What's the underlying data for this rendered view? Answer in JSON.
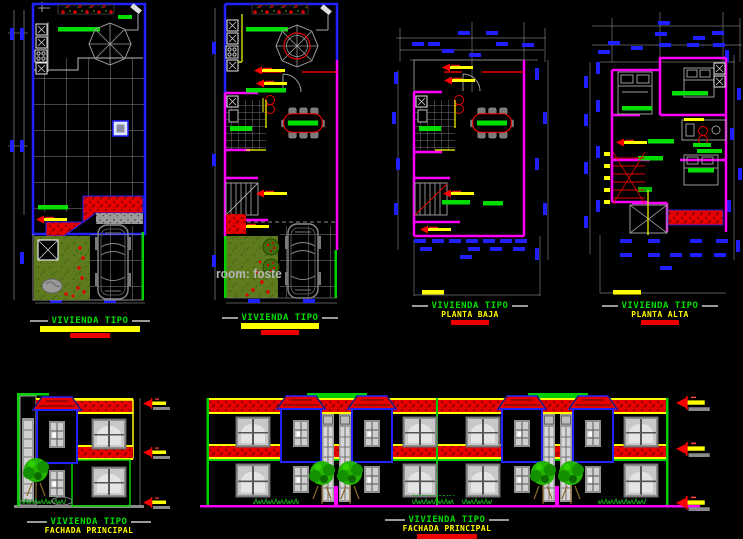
{
  "canvas": {
    "background": "#000000",
    "width": 743,
    "height": 539
  },
  "palette": {
    "wall_magenta": "#ff00ff",
    "outline_blue": "#2222ff",
    "accent_green": "#00dd00",
    "accent_yellow": "#ffff00",
    "accent_red": "#ee0000",
    "line_gray": "#9a9a9a",
    "lawn_olive": "#5d7a1c"
  },
  "drawings": {
    "roof_plan": {
      "title": "VIVIENDA TIPO"
    },
    "furnished_plan": {
      "title": "VIVIENDA TIPO"
    },
    "ground_floor_plan": {
      "title": "VIVIENDA TIPO",
      "subtitle": "PLANTA BAJA"
    },
    "upper_floor_plan": {
      "title": "VIVIENDA TIPO",
      "subtitle": "PLANTA ALTA"
    },
    "single_elevation": {
      "title": "VIVIENDA TIPO",
      "subtitle": "FACHADA PRINCIPAL"
    },
    "double_elevation": {
      "title": "VIVIENDA TIPO",
      "subtitle": "FACHADA PRINCIPAL"
    }
  },
  "watermark": {
    "text": "room: foste"
  }
}
